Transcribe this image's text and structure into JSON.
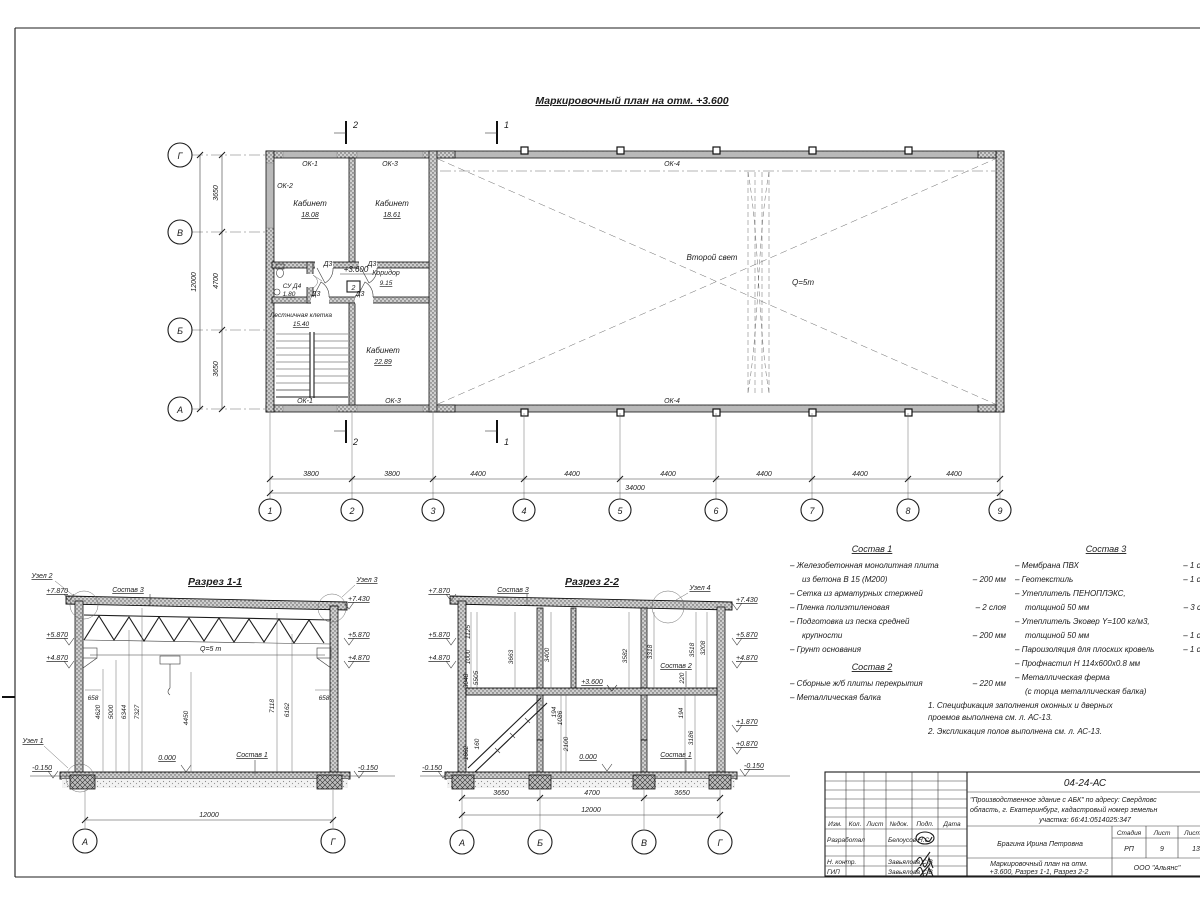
{
  "plan": {
    "title": "Маркировочный план на отм. +3.600",
    "level": "+3.600",
    "floor_mark": "2",
    "second_light": "Второй свет",
    "crane": "Q=5т",
    "door": "Д3",
    "win1": "ОК-1",
    "win2": "ОК-2",
    "win3": "ОК-3",
    "win4": "ОК-4",
    "rooms": {
      "office1": {
        "name": "Кабинет",
        "area": "18.08"
      },
      "office2": {
        "name": "Кабинет",
        "area": "18.61"
      },
      "office3": {
        "name": "Кабинет",
        "area": "22.89"
      },
      "corridor": {
        "name": "Коридор",
        "area": "9.15"
      },
      "wc": {
        "name": "СУ Д4",
        "area": "1.80"
      },
      "stair": {
        "name": "Лестничная клетка",
        "area": "15.40"
      }
    },
    "axes_v": [
      "Г",
      "В",
      "Б",
      "А"
    ],
    "axes_h": [
      "1",
      "2",
      "3",
      "4",
      "5",
      "6",
      "7",
      "8",
      "9"
    ],
    "dims_v": [
      "3650",
      "4700",
      "3650"
    ],
    "dims_v_total": "12000",
    "dims_h": [
      "3800",
      "3800",
      "4400",
      "4400",
      "4400",
      "4400",
      "4400",
      "4400"
    ],
    "dims_h_total": "34000",
    "sec_mark_1": "1",
    "sec_mark_2": "2"
  },
  "sec1": {
    "title": "Разрез 1-1",
    "node1": "Узел 1",
    "node2": "Узел 2",
    "node3": "Узел 3",
    "sostav3": "Состав 3",
    "sostav1": "Состав 1",
    "crane": "Q=5 т",
    "zero": "0.000",
    "lv_l": [
      "+7.870",
      "+5.870",
      "+4.870",
      "-0.150"
    ],
    "lv_r": [
      "+7.430",
      "+5.870",
      "+4.870",
      "-0.150"
    ],
    "d658l": "658",
    "d658r": "658",
    "dims": [
      "4620",
      "5000",
      "6344",
      "7327",
      "4450",
      "7118",
      "6162"
    ],
    "total": "12000",
    "axA": "А",
    "axG": "Г"
  },
  "sec2": {
    "title": "Разрез 2-2",
    "node4": "Узел 4",
    "sostav3": "Состав 3",
    "sostav2": "Состав 2",
    "sostav1": "Состав 1",
    "level": "+3.600",
    "zero": "0.000",
    "lv_l": [
      "+7.870",
      "+5.870",
      "+4.870",
      "-0.150"
    ],
    "lv_r": [
      "+7.430",
      "+5.870",
      "+4.870",
      "+1.870",
      "+0.870",
      "-0.150"
    ],
    "dims_l": [
      "1125",
      "1000",
      "3048",
      "5505",
      "1662",
      "160"
    ],
    "dims_m": [
      "3663",
      "3400",
      "194",
      "1086",
      "2100"
    ],
    "dims_r": [
      "3582",
      "3318",
      "3518",
      "3208",
      "220",
      "194",
      "3186"
    ],
    "dims_b": [
      "3650",
      "4700",
      "3650"
    ],
    "total": "12000",
    "axes": [
      "А",
      "Б",
      "В",
      "Г"
    ]
  },
  "spec1": {
    "title": "Состав 1",
    "items": [
      {
        "t1": "– Железобетонная  монолитная плита",
        "t2": "из бетона В 15 (М200)",
        "v": "– 200 мм"
      },
      {
        "t1": "– Сетка из арматурных стержней",
        "t2": "",
        "v": ""
      },
      {
        "t1": "– Пленка полиэтиленовая",
        "t2": "",
        "v": "– 2 слоя"
      },
      {
        "t1": "– Подготовка из песка средней",
        "t2": "крупности",
        "v": "– 200 мм"
      },
      {
        "t1": "– Грунт основания",
        "t2": "",
        "v": ""
      }
    ]
  },
  "spec2": {
    "title": "Состав 2",
    "items": [
      {
        "t1": "– Сборные ж/б плиты перекрытия",
        "v": "– 220 мм"
      },
      {
        "t1": "– Металлическая балка",
        "v": ""
      }
    ]
  },
  "spec3": {
    "title": "Состав 3",
    "items": [
      {
        "t1": "– Мембрана ПВХ",
        "v": "– 1 слой"
      },
      {
        "t1": "– Геотекстиль",
        "v": "– 1 слой"
      },
      {
        "t1": "– Утеплитель ПЕНОПЛЭКС,",
        "v": ""
      },
      {
        "t1": "толщиной 50 мм",
        "v": "– 3 слоя"
      },
      {
        "t1": "– Утеплитель Эковер Y=100 кг/м3,",
        "v": ""
      },
      {
        "t1": "толщиной 50 мм",
        "v": "– 1 слой"
      },
      {
        "t1": "– Пароизоляция для плоских кровель",
        "v": "– 1 слой"
      },
      {
        "t1": "– Профнастил Н 114х600х0.8 мм",
        "v": ""
      },
      {
        "t1": "– Металлическая ферма",
        "v": ""
      },
      {
        "t1": "(с торца металлическая балка)",
        "v": ""
      }
    ]
  },
  "notes": {
    "l1": "1. Спецификация заполнения оконных и дверных",
    "l2": "проемов выполнена см. л. АС-13.",
    "l3": "2. Экспликация полов выполнена см. л. АС-13."
  },
  "tb": {
    "code": "04-24-АС",
    "proj1": "\"Производственное здание с АБК\" по адресу: Свердловс",
    "proj2": "область, г. Екатеринбург, кадастровый номер земельн",
    "proj3": "участка: 66:41:0514025:347",
    "h_izm": "Изм.",
    "h_kol": "Кол.",
    "h_list": "Лист",
    "h_ndoc": "№док.",
    "h_podp": "Подп.",
    "h_data": "Дата",
    "r1_label": "Разработал",
    "r1_name": "Белоусов Н.С.",
    "r3_label": "Н. контр.",
    "r3_name": "Завьялова С.В",
    "r4_label": "ГИП",
    "r4_name": "Завьялова С.В",
    "gap_name": "Брагина Ирина Петровна",
    "stage_h": "Стадия",
    "sheet_h": "Лист",
    "sheets_h": "Листов",
    "stage": "РП",
    "sheet": "9",
    "sheets": "13",
    "doc1": "Маркировочный план на отм.",
    "doc2": "+3.600, Разрез 1-1, Разрез 2-2",
    "org": "ООО \"Альянс\""
  }
}
